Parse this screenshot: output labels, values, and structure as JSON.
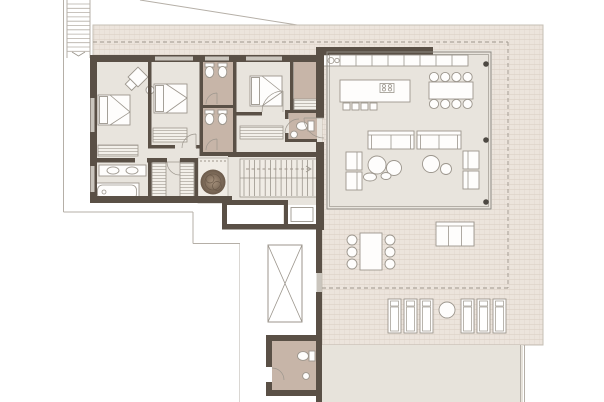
{
  "plan": {
    "kind": "residential-floor-plan",
    "wing_left": "bedrooms-and-bathrooms",
    "wing_right": "open-living-dining-kitchen",
    "outdoor": "wrap-around-tiled-terrace"
  },
  "colors": {
    "background": "#ffffff",
    "wall": "#5a5046",
    "floor": "#e8e4dd",
    "floor_light": "#f0ece5",
    "tile_bg": "#ece4dc",
    "tile_line": "#dcd1c7",
    "tile_edge": "#c6bfb5",
    "bath_floor": "#c7b5a8",
    "lawn": "#e7e3db",
    "furniture_line": "#9c968d",
    "furniture_fill": "#fefdfc",
    "glass": "#8f8a82",
    "column": "#4d4943",
    "site_line": "#b5afa7",
    "dash_line": "#9e968c",
    "window": "#cac5bd",
    "hatch_line": "#aaa49b",
    "hatch_bg": "#f3f0ea",
    "plant_dark": "#6b5a4a",
    "plant_light": "#a8937e"
  },
  "rooms": [
    "bedroom-1",
    "bedroom-2",
    "bedroom-3",
    "ensuite-bathroom-1",
    "ensuite-bathroom-2",
    "main-bathroom",
    "dressing-room",
    "wc",
    "pantry",
    "entry-hall",
    "stair-hall",
    "storage",
    "elevator-shaft",
    "light-well",
    "living-dining-kitchen",
    "lower-corridor",
    "guest-bathroom",
    "upper-terrace",
    "main-terrace",
    "lounger-deck",
    "lawn-strip"
  ],
  "furniture": [
    "bed",
    "wardrobe",
    "armchair",
    "side-table",
    "bathtub",
    "double-washbasin",
    "toilet",
    "bidet",
    "washbasin",
    "kitchen-counter",
    "kitchen-sink",
    "kitchen-island",
    "cooktop",
    "bar-stool",
    "dining-table",
    "dining-chair",
    "sofa",
    "lounge-chair",
    "coffee-table",
    "outdoor-dining-table",
    "outdoor-dining-chair",
    "outdoor-sofa",
    "sun-lounger",
    "round-side-table",
    "staircase",
    "exterior-staircase",
    "skylight-void",
    "planter-tree",
    "structural-column"
  ],
  "counts": {
    "bedrooms": 3,
    "bathrooms": 4,
    "beds": 3,
    "interior_stair_treads": 14,
    "exterior_stair_treads": 12,
    "dining_chairs": 8,
    "island_stools": 4,
    "outdoor_dining_chairs": 6,
    "sun_loungers": 6,
    "structural_columns": 3,
    "sofas": 2,
    "lounge_chairs": 4,
    "wardrobes": 5
  }
}
